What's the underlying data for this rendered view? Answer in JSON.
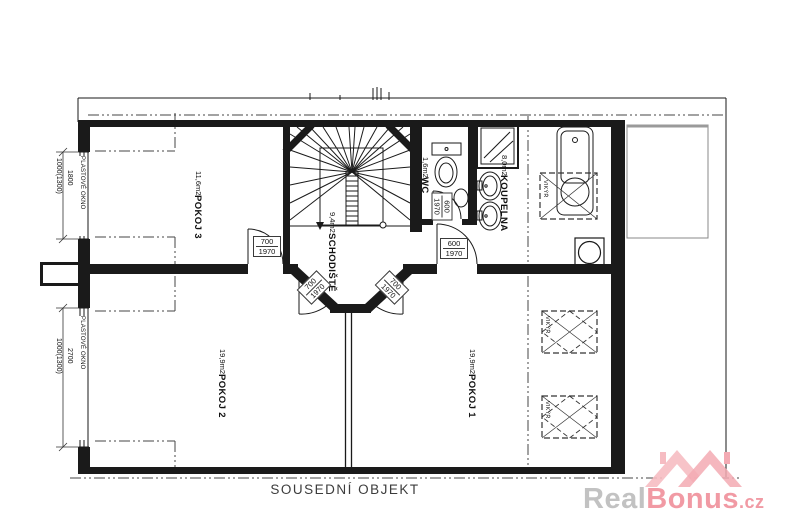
{
  "plan": {
    "rooms": [
      {
        "name": "POKOJ 3",
        "area": "11,6m2"
      },
      {
        "name": "SCHODIŠTĚ",
        "area": "9,4m2"
      },
      {
        "name": "WC",
        "area": "1,6m2"
      },
      {
        "name": "KOUPELNA",
        "area": "8,0m2"
      },
      {
        "name": "POKOJ 2",
        "area": "19,9m2"
      },
      {
        "name": "POKOJ 1",
        "area": "19,9m2"
      }
    ],
    "doors": [
      {
        "w": "700",
        "h": "1970"
      },
      {
        "w": "600",
        "h": "1970"
      },
      {
        "w": "600",
        "h": "1970"
      },
      {
        "w": "700",
        "h": "1970"
      },
      {
        "w": "700",
        "h": "1970"
      }
    ],
    "windows": [
      {
        "label": "PLASTOVÉ OKNO",
        "width_mm": "1800",
        "sill": "1000(1300)"
      },
      {
        "label": "PLASTOVÉ OKNO",
        "width_mm": "2700",
        "sill": "1000(1300)"
      }
    ],
    "skylight": {
      "label": "VIKÝŘ"
    },
    "neighbor_building_label": "SOUSEDNÍ OBJEKT"
  },
  "watermark": {
    "gray_part": "Real",
    "pink_part": "Bonus",
    "tld": ".cz"
  },
  "colors": {
    "line": "#1a1a1a",
    "dashdot": "#444444",
    "watermark_gray": "#c2c2c2",
    "watermark_pink": "#f19aa4",
    "logo_pink": "#f5b8bf"
  }
}
